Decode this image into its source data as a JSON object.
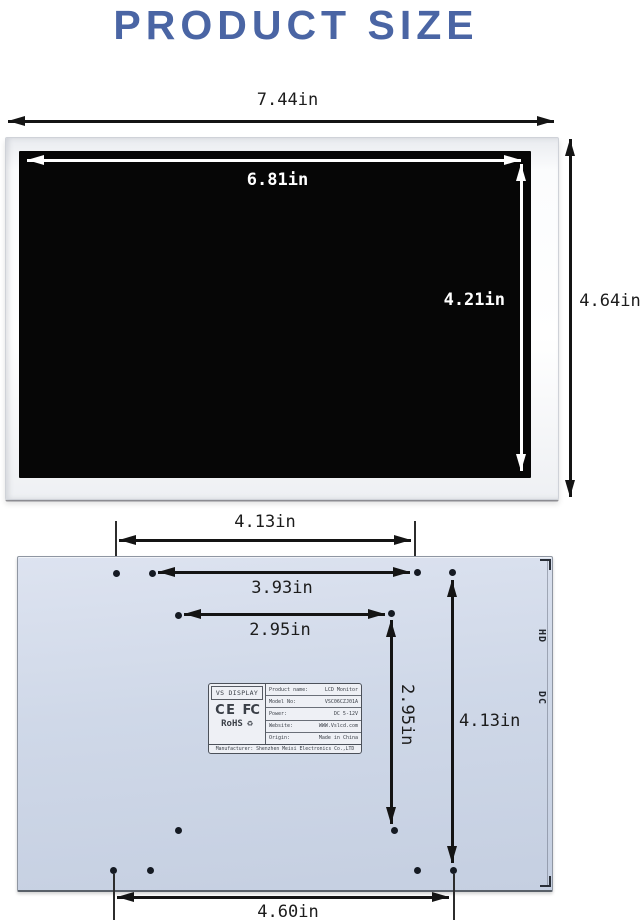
{
  "title": "PRODUCT SIZE",
  "colors": {
    "title_blue": "#4a65a4",
    "back_panel_blue": "#ccd5e6",
    "arrow_black": "#141414",
    "inner_arrow_white": "#ffffff"
  },
  "front_view": {
    "outer_width": "7.44in",
    "screen_width": "6.81in",
    "screen_height": "4.21in",
    "outer_height": "4.64in"
  },
  "back_view": {
    "top_hole_span": "4.13in",
    "upper_hole_span": "3.93in",
    "inner_hole_span": "2.95in",
    "vertical_inner_span": "2.95in",
    "vertical_outer_span": "4.13in",
    "bottom_hole_span": "4.60in",
    "ports": {
      "hd": "HD",
      "dc": "DC"
    },
    "sticker": {
      "brand": "VS DISPLAY",
      "ce_mark": "CE",
      "fcc_mark": "FC",
      "rohs": "RoHS",
      "recycle_icon": "♻",
      "specs": [
        {
          "label": "Product name:",
          "value": "LCD Monitor"
        },
        {
          "label": "Model No:",
          "value": "VSC06CZJ01A"
        },
        {
          "label": "Power:",
          "value": "DC 5-12V"
        },
        {
          "label": "Website:",
          "value": "WWW.Vslcd.com"
        },
        {
          "label": "Origin:",
          "value": "Made in China"
        }
      ],
      "manufacturer": "Manufacturer: Shenzhen Meisi Electronics Co.,LTD"
    }
  }
}
